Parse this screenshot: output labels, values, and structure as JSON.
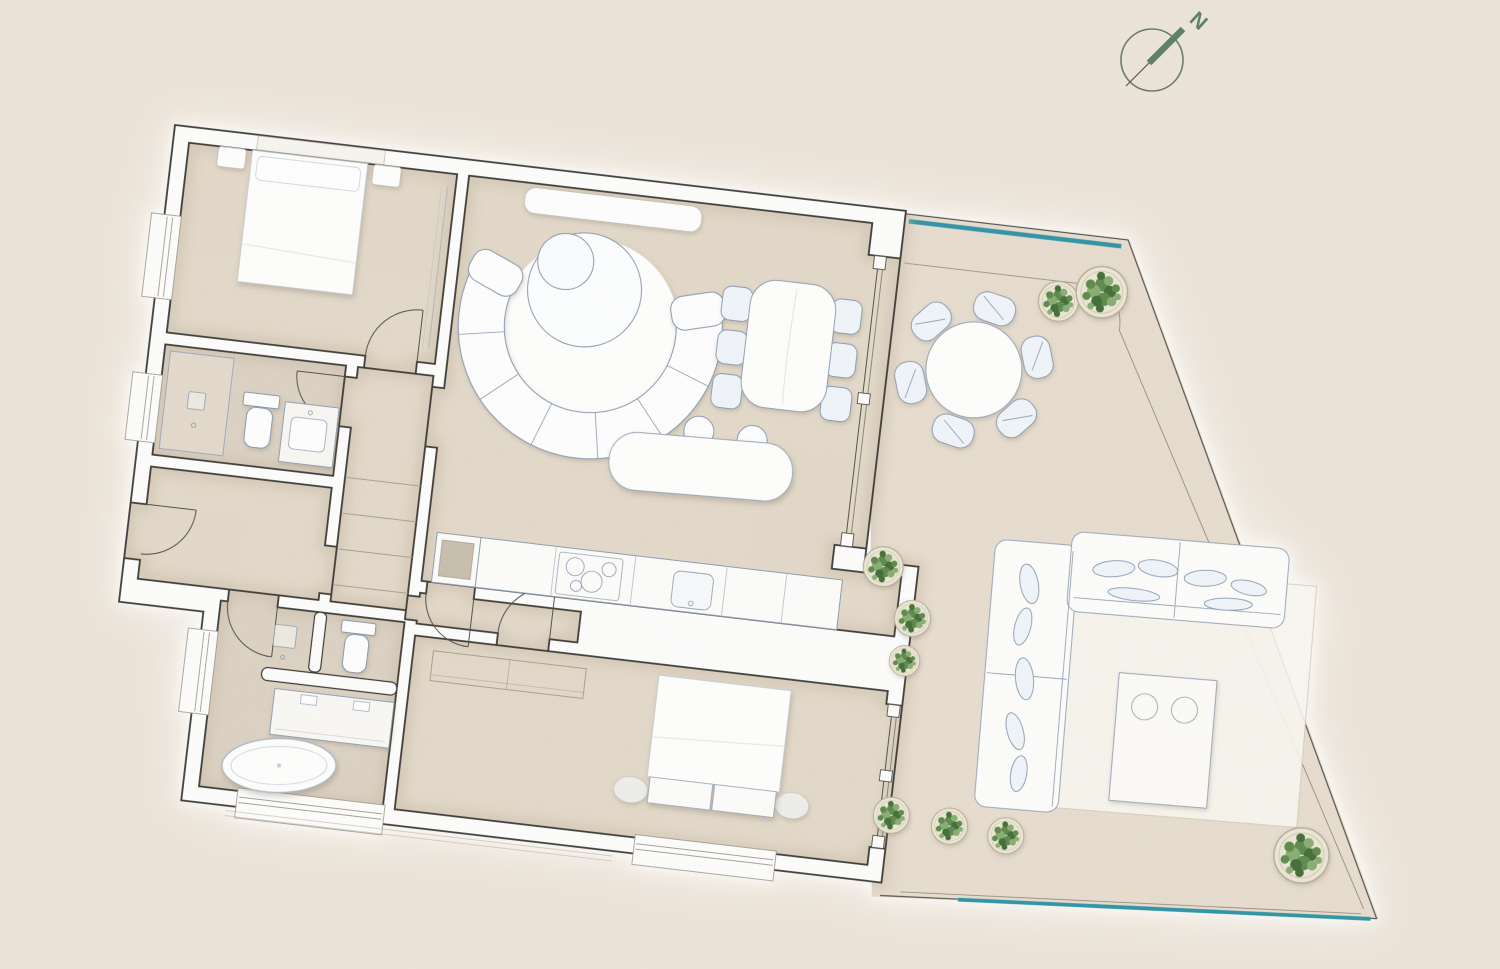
{
  "compass": {
    "label": "N"
  },
  "palette": {
    "background": "#ece4d9",
    "floor": "#e6dccd",
    "floor_bath": "#d8cec1",
    "terrace_floor": "#eae0d3",
    "wall_fill": "#fcfcfb",
    "wall_line": "#3d3c38",
    "thin_line": "#a9a193",
    "furniture_line": "#8b9bb0",
    "furniture_fill": "#fdfdfe",
    "chair_fill": "#eff4f9",
    "glass_teal": "#2f96a8",
    "pot": "#ebe5d3",
    "green_1": "#5f8c4f",
    "green_2": "#476f3c",
    "green_3": "#8aae74",
    "compass_green": "#5d8266",
    "compass_ring": "#6b7c6e"
  },
  "legend": {
    "rooms": [
      "bedroom-1",
      "bathroom-1",
      "entry-hall",
      "corridor-closet",
      "living-dining-kitchen",
      "lower-hall",
      "master-bathroom",
      "bedroom-2",
      "terrace"
    ],
    "furniture": [
      "double-bed",
      "nightstands",
      "curved-sectional-sofa",
      "round-rug",
      "coffee-tables",
      "media-console",
      "dining-table-6-chairs",
      "kitchen-island-stools",
      "kitchen-counter-cooktop-sink",
      "shower",
      "toilet",
      "vanity",
      "freestanding-bathtub",
      "wardrobe",
      "bed-bench",
      "poufs"
    ],
    "outdoor": [
      "round-table-6-chairs",
      "l-shaped-outdoor-sofa",
      "outdoor-rug",
      "outdoor-coffee-table",
      "potted-plants",
      "glass-balustrade"
    ]
  }
}
